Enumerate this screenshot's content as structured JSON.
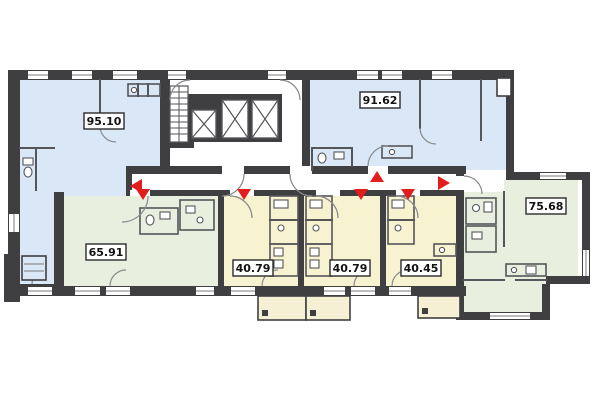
{
  "floor_plan": {
    "type": "residential-floor-plan",
    "background": "#ffffff",
    "colors": {
      "wall": "#3f3f41",
      "partition": "#55565a",
      "room_blue": "#d9e7f6",
      "room_green": "#e9efdf",
      "room_yellow": "#f7f2d0",
      "balcony_cream": "#f5f0d4",
      "arrow_red": "#e21d1d",
      "label_bg": "#ffffff",
      "label_border": "#2b2b2b",
      "label_text": "#121212"
    },
    "apartments": [
      {
        "id": "apt-1",
        "area": "95.10",
        "color_key": "room_blue",
        "position": "top-left"
      },
      {
        "id": "apt-2",
        "area": "91.62",
        "color_key": "room_blue",
        "position": "top-right"
      },
      {
        "id": "apt-3",
        "area": "65.91",
        "color_key": "room_green",
        "position": "bottom-left"
      },
      {
        "id": "apt-4",
        "area": "40.79",
        "color_key": "room_yellow",
        "position": "bottom-center-left"
      },
      {
        "id": "apt-5",
        "area": "40.79",
        "color_key": "room_yellow",
        "position": "bottom-center"
      },
      {
        "id": "apt-6",
        "area": "40.45",
        "color_key": "room_yellow",
        "position": "bottom-center-right"
      },
      {
        "id": "apt-7",
        "area": "75.68",
        "color_key": "room_green",
        "position": "bottom-right"
      }
    ],
    "entrance_arrows": [
      {
        "direction": "left",
        "into": "95.10"
      },
      {
        "direction": "down",
        "into": "65.91"
      },
      {
        "direction": "down",
        "into": "40.79"
      },
      {
        "direction": "down",
        "into": "40.79"
      },
      {
        "direction": "up",
        "into": "91.62"
      },
      {
        "direction": "down",
        "into": "40.45"
      },
      {
        "direction": "right",
        "into": "75.68"
      }
    ],
    "core": {
      "staircase": true,
      "elevator_count": 3
    }
  }
}
